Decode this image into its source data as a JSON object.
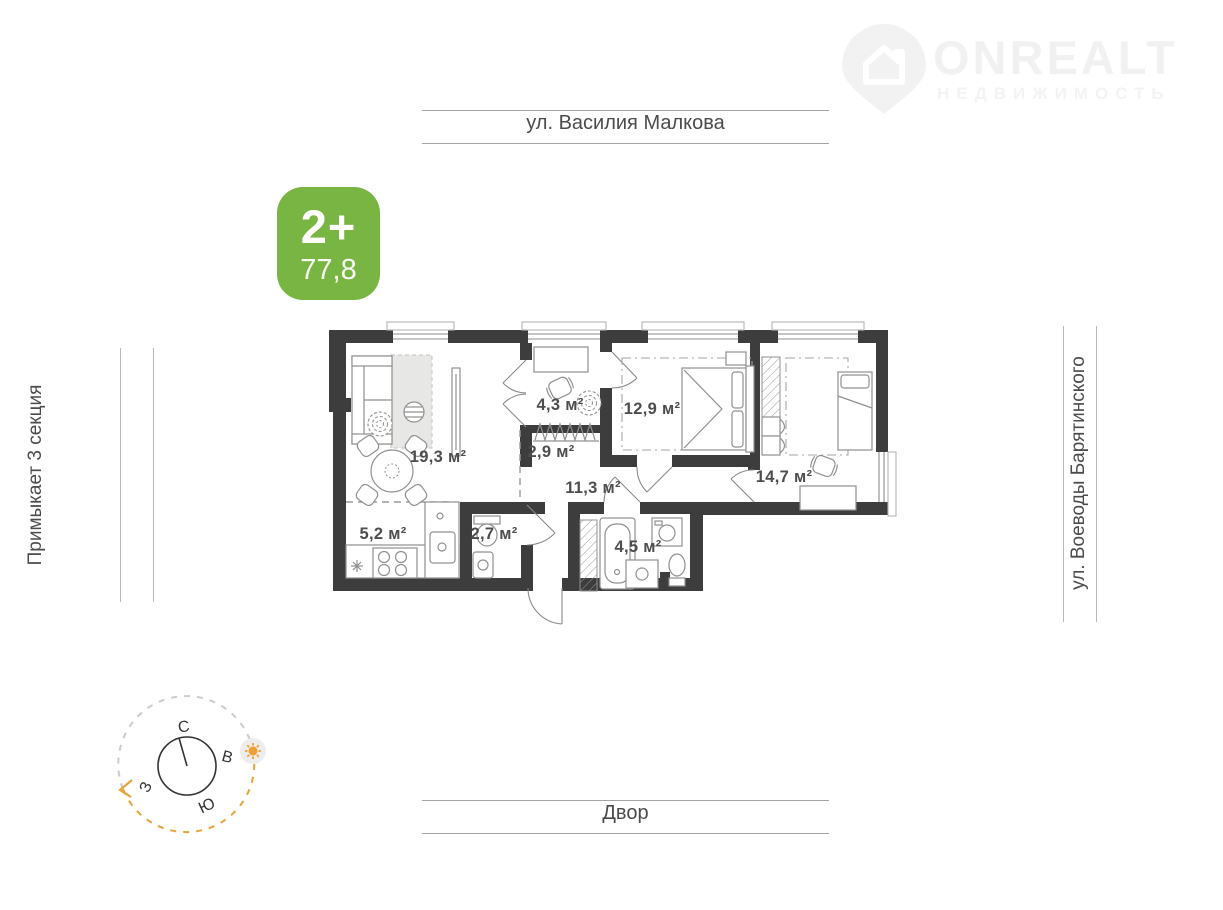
{
  "logo": {
    "brand": "ONREALT",
    "tagline": "НЕДВИЖИМОСТЬ"
  },
  "badge": {
    "rooms_label": "2+",
    "area_label": "77,8"
  },
  "surroundings": {
    "top_street": "ул. Василия Малкова",
    "left_label": "Примыкает 3 секция",
    "right_street": "ул. Воеводы Барятинского",
    "bottom_label": "Двор"
  },
  "floor_plan": {
    "rooms": [
      {
        "id": "living-room",
        "label": "19,3 м²"
      },
      {
        "id": "kitchen",
        "label": "5,2 м²"
      },
      {
        "id": "toilet",
        "label": "2,7 м²"
      },
      {
        "id": "study",
        "label": "4,3 м²"
      },
      {
        "id": "wardrobe",
        "label": "2,9 м²"
      },
      {
        "id": "corridor",
        "label": "11,3 м²"
      },
      {
        "id": "bedroom",
        "label": "12,9 м²"
      },
      {
        "id": "bathroom",
        "label": "4,5 м²"
      },
      {
        "id": "bedroom-2",
        "label": "14,7 м²"
      }
    ]
  },
  "compass": {
    "north": "С",
    "east": "В",
    "south": "Ю",
    "west": "З"
  },
  "colors": {
    "badge_green": "#79b543",
    "sun_orange": "#e9a23b",
    "wall_dark": "#3d3d3d"
  }
}
